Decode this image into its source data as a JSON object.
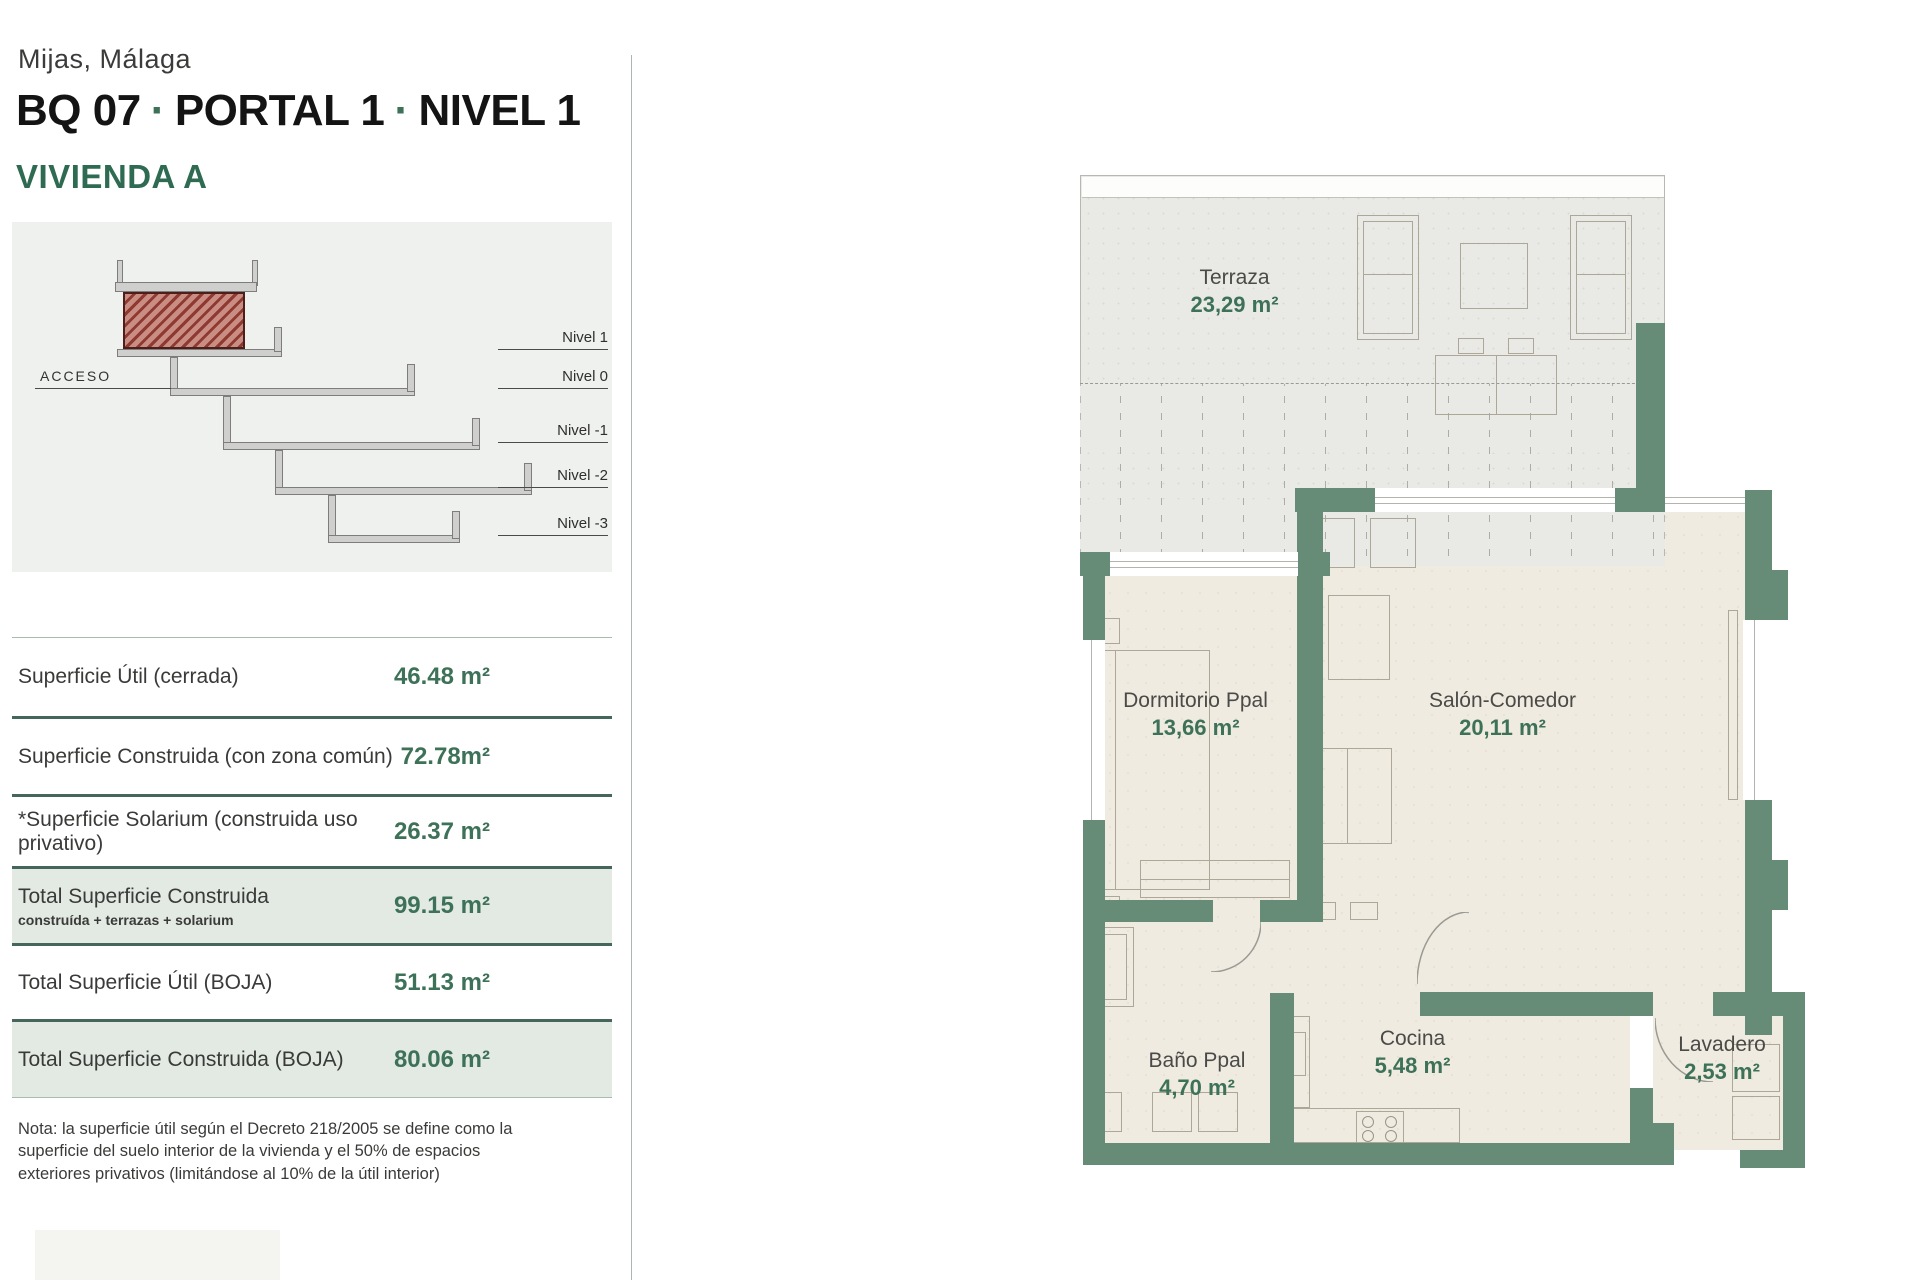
{
  "page": {
    "location": "Mijas, Málaga",
    "title": {
      "parts": [
        "BQ 07",
        "PORTAL 1",
        "NIVEL 1"
      ],
      "separator": "·"
    },
    "unit_name": "VIVIENDA A"
  },
  "section_diagram": {
    "acceso_label": "ACCESO",
    "level_labels": [
      "Nivel 1",
      "Nivel 0",
      "Nivel -1",
      "Nivel -2",
      "Nivel -3"
    ]
  },
  "surface_table": {
    "rows": [
      {
        "label": "Superficie Útil (cerrada)",
        "value": "46.48 m²"
      },
      {
        "label": "Superficie Construida (con zona común)",
        "value": "72.78m²"
      },
      {
        "label": "*Superficie Solarium (construida uso privativo)",
        "value": "26.37 m²"
      },
      {
        "label": "Total Superficie Construida",
        "sublabel": "construída + terrazas + solarium",
        "value": "99.15 m²"
      },
      {
        "label": "Total Superficie Útil (BOJA)",
        "value": "51.13 m²"
      },
      {
        "label": "Total Superficie Construida (BOJA)",
        "value": "80.06 m²"
      }
    ]
  },
  "note_text": "Nota: la superficie útil según el Decreto 218/2005 se define como la superficie del suelo interior de la vivienda y el 50% de espacios exteriores privativos (limitándose al 10% de la útil interior)",
  "floor_plan": {
    "rooms": [
      {
        "name": "Terraza",
        "area": "23,29 m²"
      },
      {
        "name": "Dormitorio Ppal",
        "area": "13,66 m²"
      },
      {
        "name": "Salón-Comedor",
        "area": "20,11 m²"
      },
      {
        "name": "Baño Ppal",
        "area": "4,70 m²"
      },
      {
        "name": "Cocina",
        "area": "5,48 m²"
      },
      {
        "name": "Lavadero",
        "area": "2,53 m²"
      }
    ]
  },
  "colors": {
    "accent_green": "#2e6b52",
    "value_green": "#3d7158",
    "wall_green": "#668b77",
    "row_highlight": "#e3eae4",
    "section_panel_bg": "#eef1ee",
    "terrace_floor": "#e9e9e5",
    "room_floor": "#efebe0",
    "hatch_red": "#8e3a30"
  }
}
